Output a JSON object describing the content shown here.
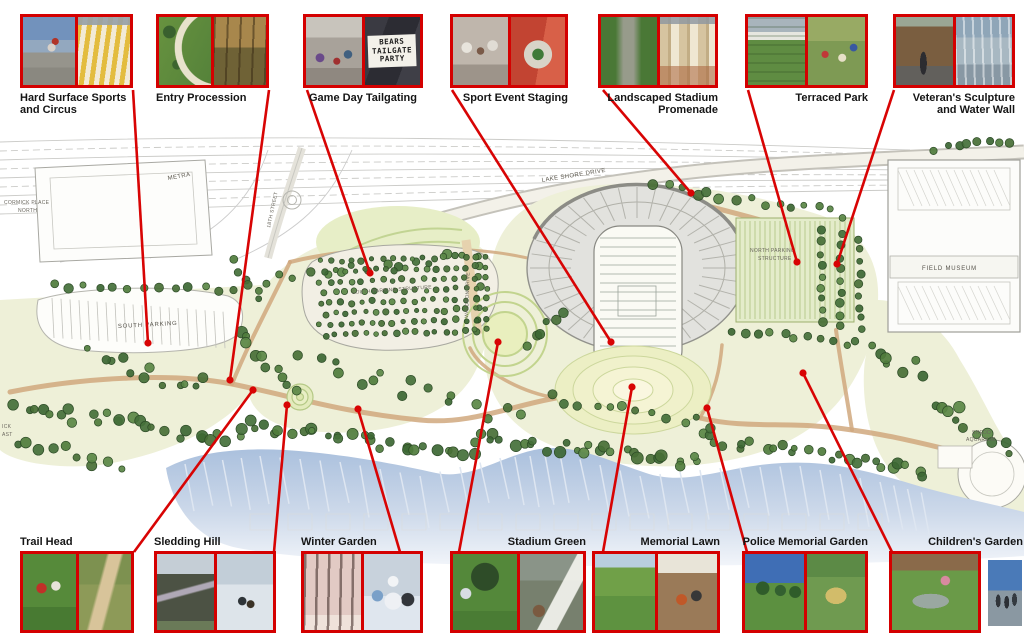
{
  "callouts": {
    "top": [
      {
        "label": "Hard Surface Sports and Circus"
      },
      {
        "label": "Entry Procession"
      },
      {
        "label": "Game Day Tailgating"
      },
      {
        "label": "Sport Event Staging"
      },
      {
        "label": "Landscaped Stadium Promenade"
      },
      {
        "label": "Terraced Park"
      },
      {
        "label": "Veteran's Sculpture and Water Wall"
      }
    ],
    "bottom": [
      {
        "label": "Trail Head"
      },
      {
        "label": "Sledding Hill"
      },
      {
        "label": "Winter Garden"
      },
      {
        "label": "Stadium Green"
      },
      {
        "label": "Memorial Lawn"
      },
      {
        "label": "Police Memorial Garden"
      },
      {
        "label": "Children's Garden"
      }
    ]
  },
  "photo_sign": {
    "line1": "BEARS",
    "line2": "TAILGATE",
    "line3": "PARTY"
  },
  "plan_labels": {
    "mccormick_line1": "CORMICK PLACE",
    "mccormick_line2": "NORTH",
    "metra": "METRA",
    "street_18th": "18TH STREET",
    "lake_shore_drive": "LAKE SHORE DRIVE",
    "south_parking": "SOUTH PARKING",
    "south_parking_structure": "SOUTH PARKING STRUCTURE",
    "waldron_drive": "WALDRON DRIVE",
    "north_parking_line1": "NORTH PARKING",
    "north_parking_line2": "STRUCTURE",
    "field_museum": "FIELD MUSEUM",
    "shedd_line1": "SHEDD",
    "shedd_line2": "AQUARIUM",
    "edge_line1": "ICK",
    "edge_line2": "AST"
  },
  "colors": {
    "accent_red": "#d40000",
    "lake_blue": "#aac0dd",
    "tree_green": "#4a7240",
    "path_tan": "#d0a87e"
  }
}
